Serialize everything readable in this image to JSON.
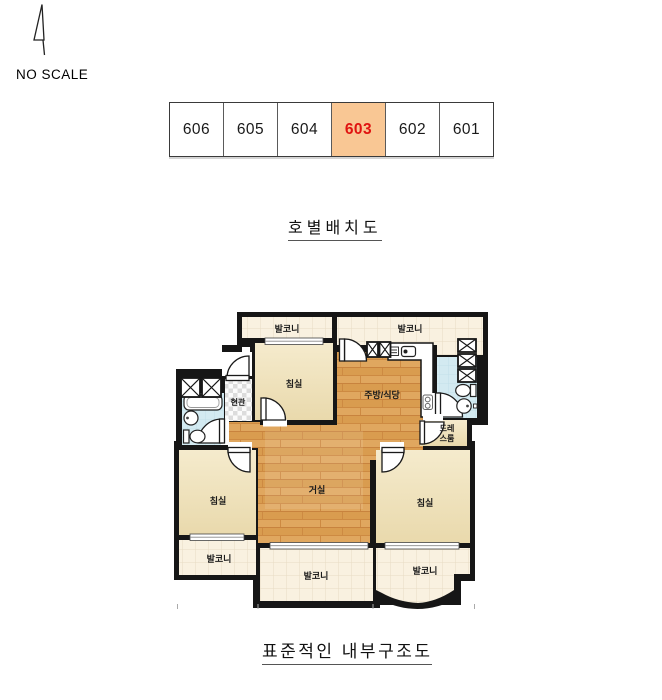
{
  "north": {
    "no_scale_label": "NO SCALE"
  },
  "unit_table": {
    "units": [
      {
        "label": "606",
        "highlighted": false
      },
      {
        "label": "605",
        "highlighted": false
      },
      {
        "label": "604",
        "highlighted": false
      },
      {
        "label": "603",
        "highlighted": true
      },
      {
        "label": "602",
        "highlighted": false
      },
      {
        "label": "601",
        "highlighted": false
      }
    ],
    "highlight_bg": "#f9c794",
    "highlight_text": "#e01310"
  },
  "section_titles": {
    "unit_layout": "호별배치도",
    "floor_plan": "표준적인 내부구조도"
  },
  "floor_plan": {
    "rooms": {
      "balcony_top_left": "발코니",
      "balcony_top_right": "발코니",
      "bedroom_top": "침실",
      "kitchen_dining": "주방/식당",
      "entrance": "현관",
      "dressroom_line1": "드레",
      "dressroom_line2": "스룸",
      "living": "거실",
      "bedroom_left": "침실",
      "bedroom_right": "침실",
      "balcony_bottom_left": "발코니",
      "balcony_bottom_center": "발코니",
      "balcony_bottom_right": "발코니"
    },
    "colors": {
      "wall": "#161616",
      "wood_floor": "#dba158",
      "wood_line": "#c8833e",
      "bedroom_floor": "#f1e5c2",
      "balcony_tile": "#f9f1e0",
      "tile_line": "#e7dcc3",
      "bathroom": "#d3eaf1",
      "entrance_checker": "#dddddd"
    }
  }
}
